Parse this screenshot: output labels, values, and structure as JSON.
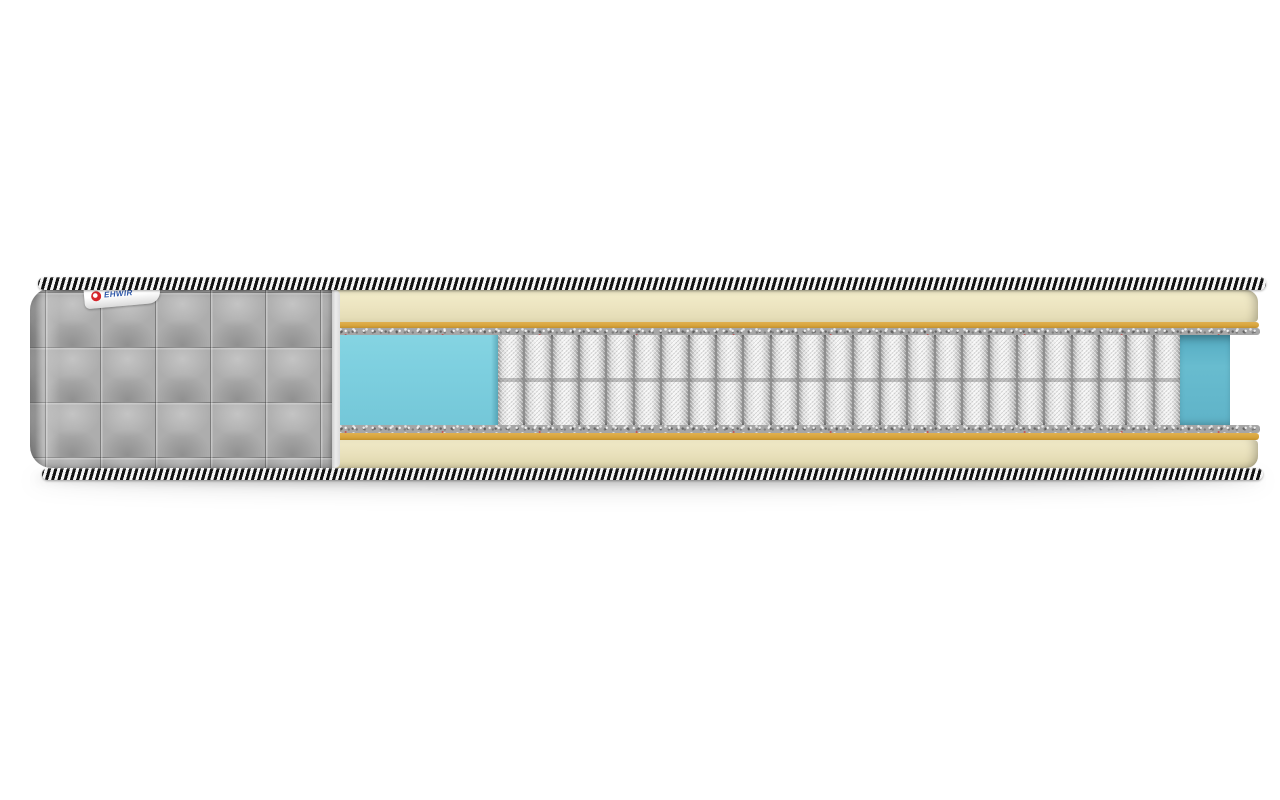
{
  "background_color": "#ffffff",
  "brand_tag": {
    "text": "EHWIR",
    "text_color": "#2b55a8",
    "logo_color": "#d6252b",
    "background": "#ffffff"
  },
  "mattress": {
    "cover": {
      "color": "#adadad",
      "quilt_pattern": "square-55px"
    },
    "piping": {
      "dark": "#121212",
      "light": "#f4f4f4"
    },
    "layers": {
      "top_foam_color": "#ece4c0",
      "latex_color": "#d7a43c",
      "felt_color": "#a6a6a6",
      "comfort_foam_color": "#7dcfdf",
      "back_wall_color": "#5fb3c8",
      "spring_fabric_color": "#f0f0f0",
      "spring_count": 25
    }
  }
}
